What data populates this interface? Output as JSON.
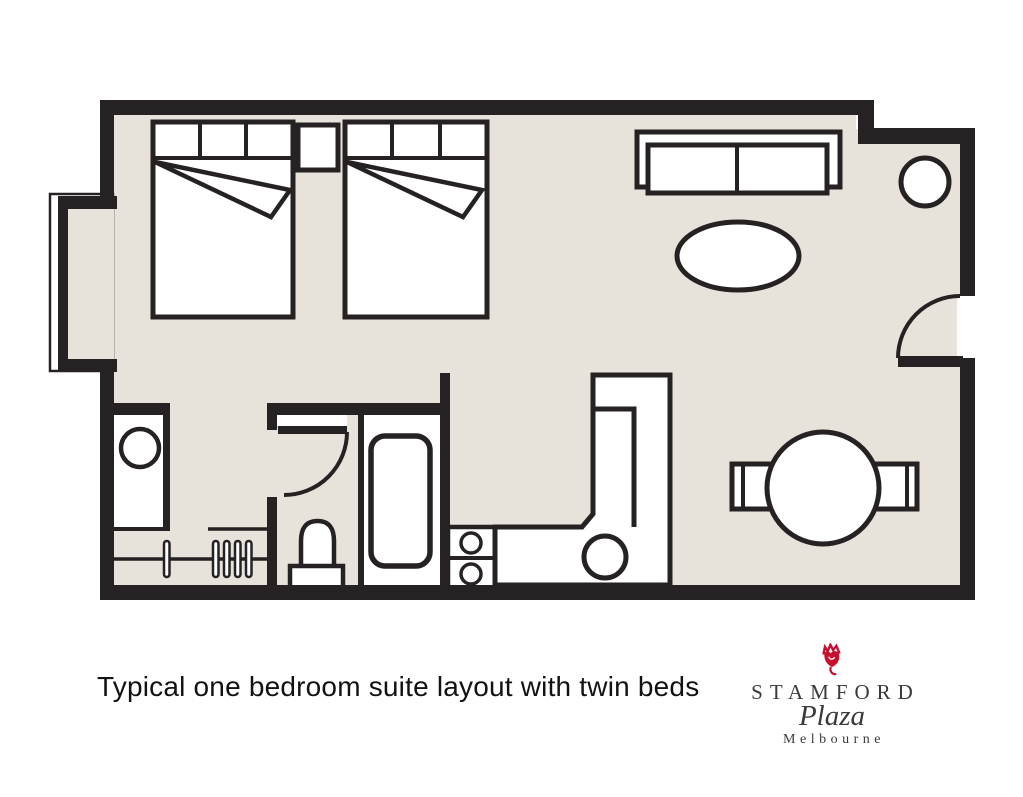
{
  "caption": "Typical one bedroom suite layout with twin beds",
  "logo": {
    "hotel_name": "STAMFORD",
    "brand_script": "Plaza",
    "city": "Melbourne"
  },
  "colors": {
    "floor_beige": "#e8e3da",
    "wall_black": "#262223",
    "furniture_white": "#ffffff",
    "logo_red": "#c8102e",
    "logo_text": "#3a3a3a",
    "caption_text": "#121212"
  },
  "icons": {
    "rose": "rose-icon"
  },
  "floorplan_elements": [
    "bay-window",
    "twin-bed-1",
    "twin-bed-2",
    "nightstand",
    "sofa",
    "coffee-table",
    "side-table",
    "entry-door",
    "dining-table",
    "dining-chair-left",
    "dining-chair-right",
    "kitchen-counter",
    "kitchen-sink",
    "cooktop-hotplates",
    "bathtub",
    "toilet",
    "vanity-basin",
    "wardrobe-rail",
    "coat-hangers",
    "bathroom-door"
  ]
}
